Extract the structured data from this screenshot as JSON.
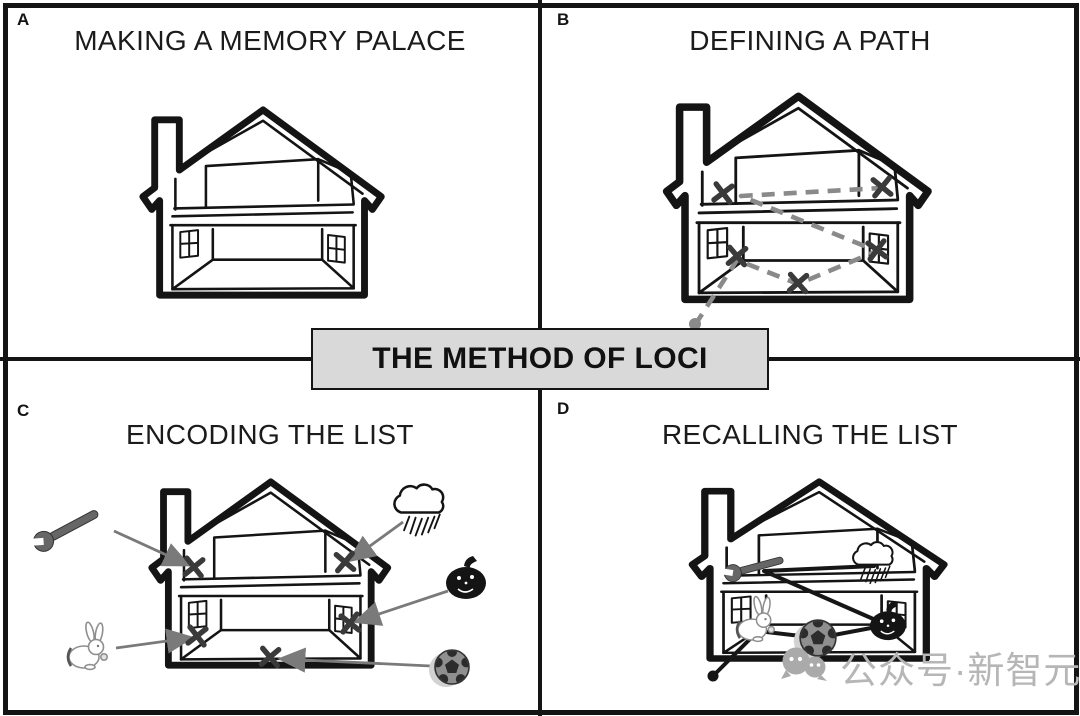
{
  "figure": {
    "banner": {
      "title": "THE METHOD OF LOCI"
    },
    "panels": [
      {
        "label": "A",
        "title": "MAKING A MEMORY PALACE"
      },
      {
        "label": "B",
        "title": "DEFINING A PATH"
      },
      {
        "label": "C",
        "title": "ENCODING THE LIST"
      },
      {
        "label": "D",
        "title": "RECALLING THE LIST"
      }
    ],
    "loci_count": 5,
    "list_items": [
      "wrench",
      "storm cloud",
      "rabbit",
      "soccer ball",
      "pumpkin"
    ],
    "watermark": {
      "icon": "wechat-bubbles-icon",
      "text": "公众号·新智元"
    },
    "colors": {
      "line": "#141414",
      "banner_bg": "#d9d9d9",
      "dashed_path": "#8a8a8a",
      "arrow": "#7a7a7a",
      "x_mark": "#3a3a3a",
      "watermark": "#b6b6b6"
    }
  }
}
